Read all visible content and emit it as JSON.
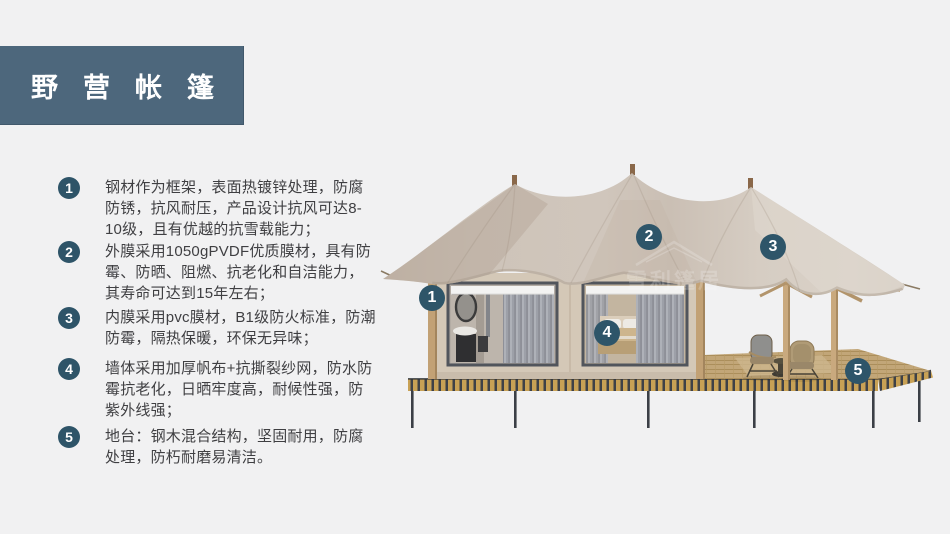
{
  "title": {
    "text": "野营帐篷"
  },
  "features": [
    {
      "num": "1",
      "text": "钢材作为框架，表面热镀锌处理，防腐防锈，抗风耐压，产品设计抗风可达8-10级，且有优越的抗雪载能力；"
    },
    {
      "num": "2",
      "text": "外膜采用1050gPVDF优质膜材，具有防霉、防晒、阻燃、抗老化和自洁能力，其寿命可达到15年左右；"
    },
    {
      "num": "3",
      "text": "内膜采用pvc膜材，B1级防火标准，防潮防霉，隔热保暖，环保无异味；"
    },
    {
      "num": "4",
      "text": "墙体采用加厚帆布+抗撕裂纱网，防水防霉抗老化，日晒牢度高，耐候性强，防紫外线强；"
    },
    {
      "num": "5",
      "text": "地台：钢木混合结构，坚固耐用，防腐处理，防朽耐磨易清洁。"
    }
  ],
  "diagram": {
    "description": "luxury safari glamping tent on raised platform",
    "watermark": "雪利篷居",
    "badge_color": "#2e5569",
    "callouts": [
      {
        "num": "1",
        "cx": 432,
        "cy": 298
      },
      {
        "num": "2",
        "cx": 649,
        "cy": 237
      },
      {
        "num": "3",
        "cy": 247,
        "cx": 773
      },
      {
        "num": "4",
        "cx": 607,
        "cy": 333
      },
      {
        "num": "5",
        "cx": 858,
        "cy": 371
      }
    ]
  },
  "colors": {
    "page_bg": "#f1f1f2",
    "title_bg": "#4d677c",
    "title_text": "#ffffff",
    "bullet_circle": "#2e5468",
    "body_text": "#3f3f42",
    "tent_fabric": "#cfc5bb",
    "deck_gold": "#c8a155",
    "wood_post": "#c2a175"
  }
}
